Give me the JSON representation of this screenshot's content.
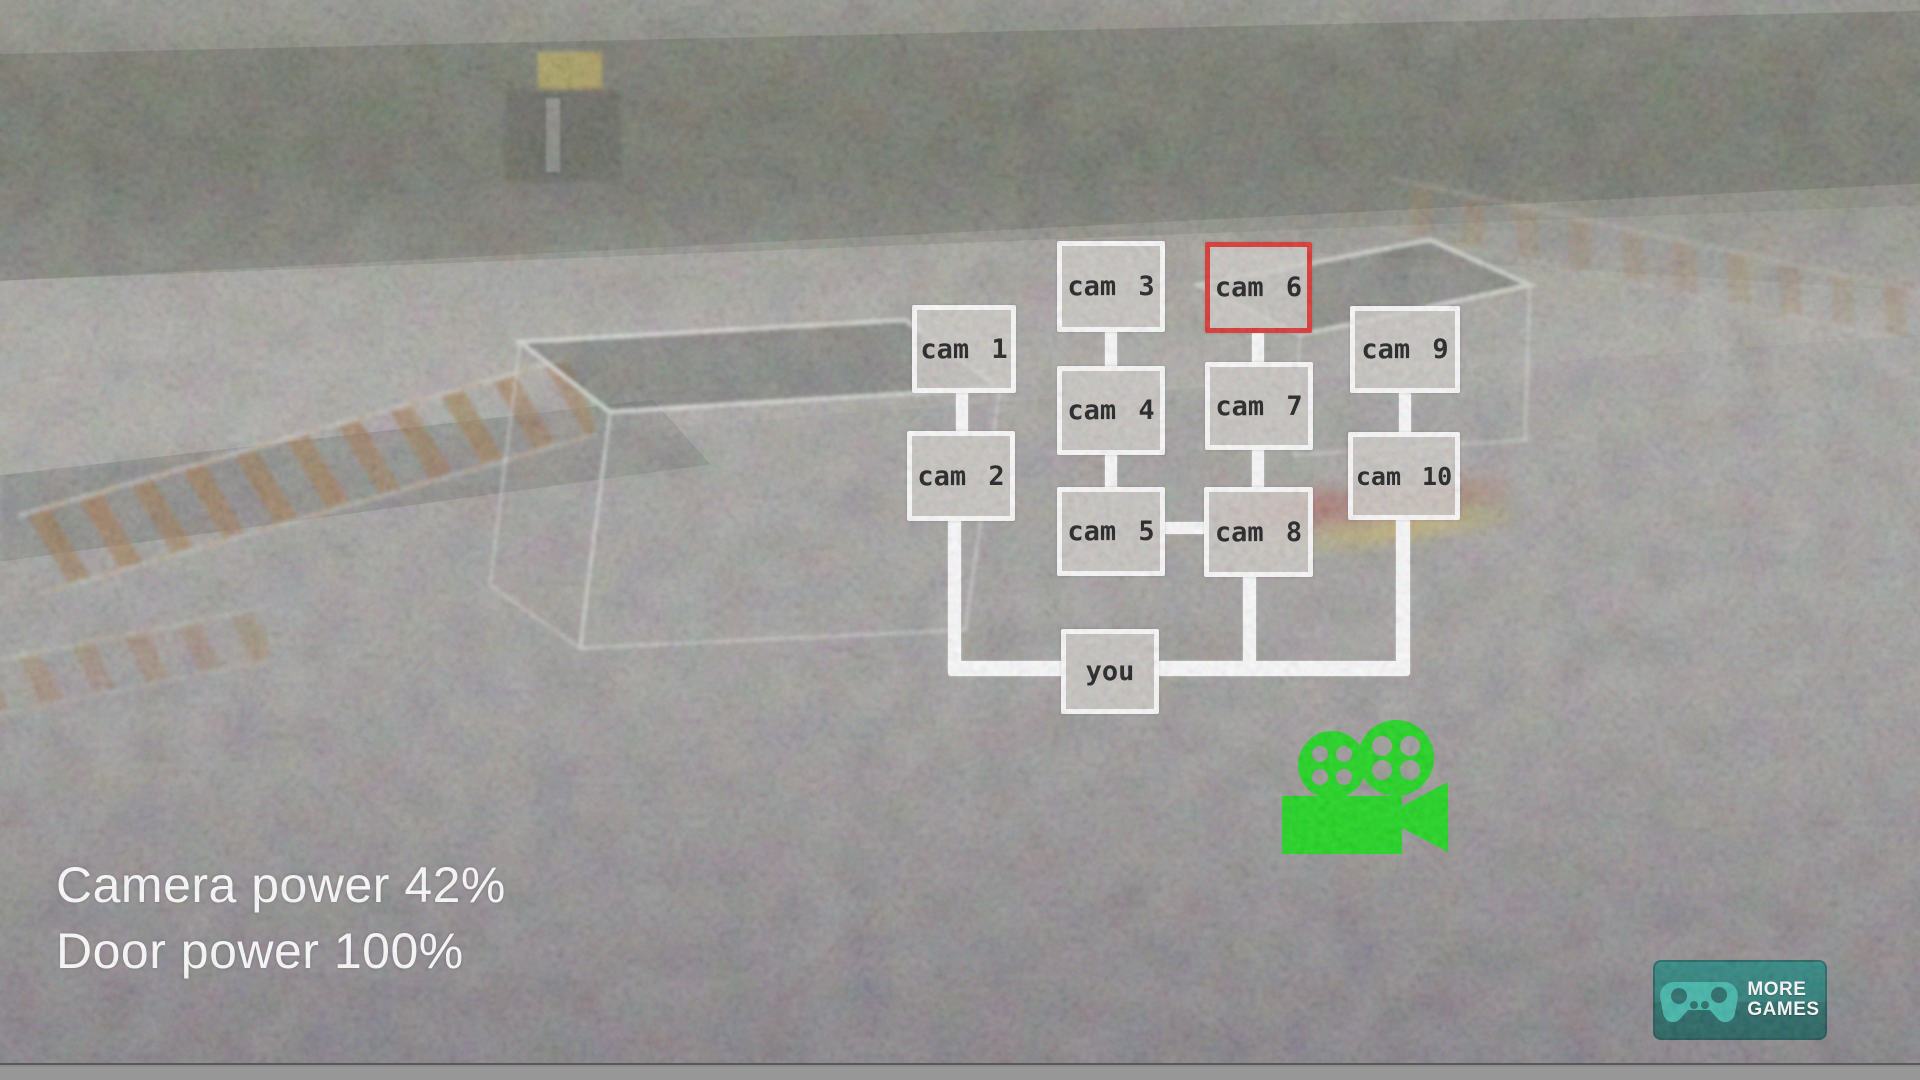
{
  "hud": {
    "camera_power": {
      "label": "Camera power",
      "value": "42%"
    },
    "door_power": {
      "label": "Door power",
      "value": "100%"
    }
  },
  "camera_map": {
    "selected_camera": "cam 6",
    "cameras": [
      {
        "label": "cam 1"
      },
      {
        "label": "cam 2"
      },
      {
        "label": "cam 3"
      },
      {
        "label": "cam 4"
      },
      {
        "label": "cam 5"
      },
      {
        "label": "cam 6"
      },
      {
        "label": "cam 7"
      },
      {
        "label": "cam 8"
      },
      {
        "label": "cam 9"
      },
      {
        "label": "cam 10"
      }
    ],
    "player_label": "you"
  },
  "footer": {
    "more_games": {
      "line1": "MORE",
      "line2": "GAMES"
    }
  },
  "icons": {
    "film_camera": "film-camera-icon",
    "gamepad": "gamepad-icon"
  },
  "colors": {
    "selected_camera_border": "#da241f",
    "camera_button_border": "#ffffff",
    "film_camera_green": "#0bd40b",
    "more_games_background": "#135e5a",
    "more_games_gamepad": "#31b2a4"
  }
}
